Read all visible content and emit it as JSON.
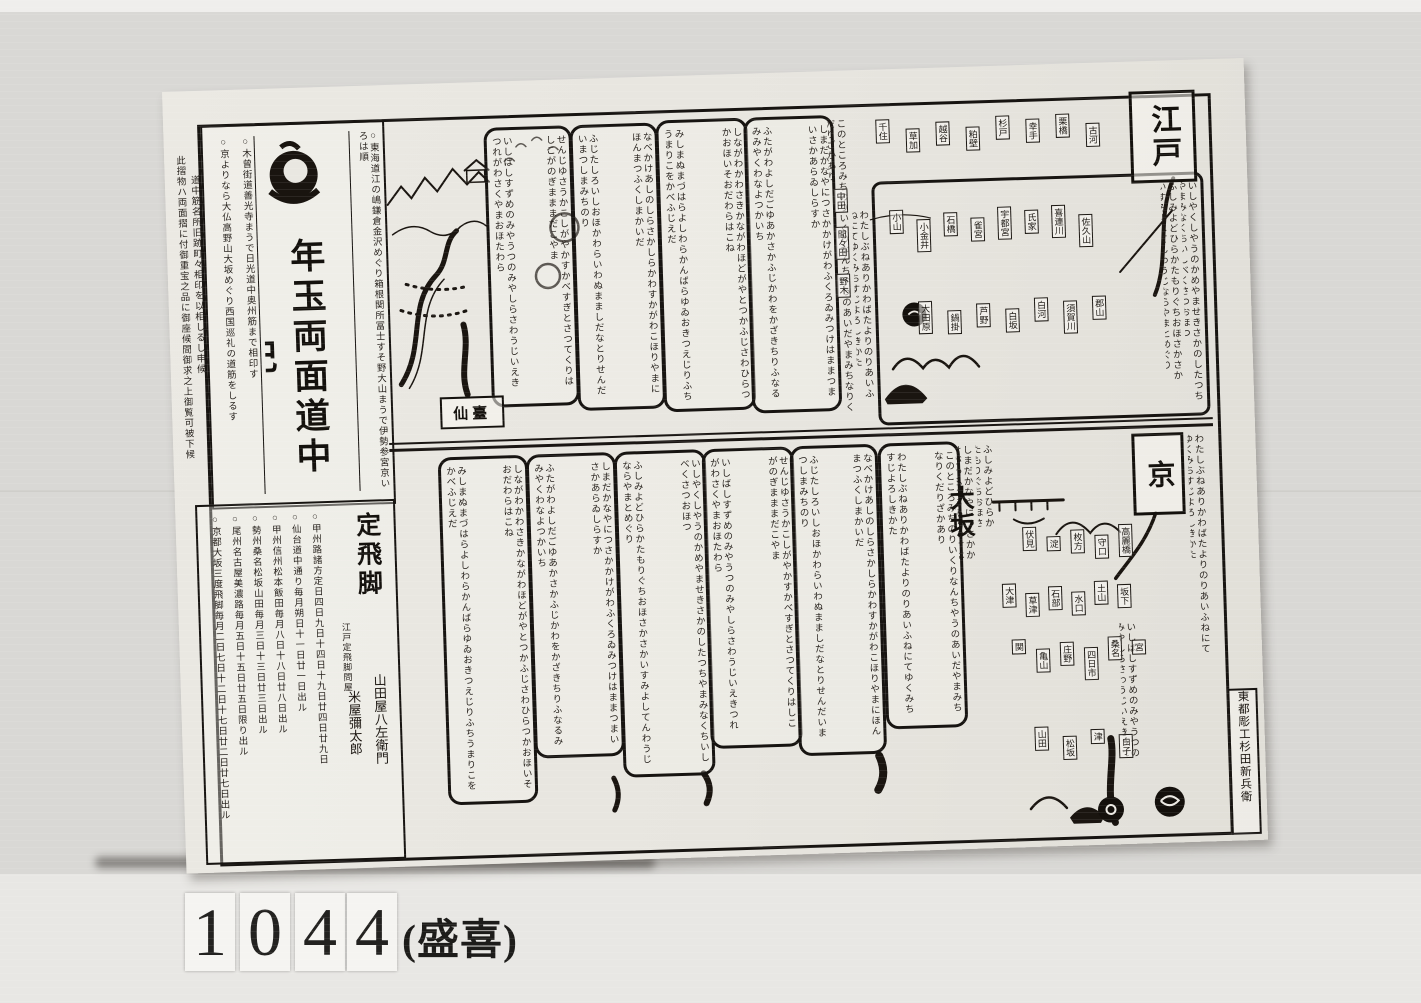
{
  "catalog": {
    "digits": [
      "1",
      "0",
      "4",
      "4"
    ],
    "annotation": "(盛喜)"
  },
  "sheet": {
    "title": "年玉両面道中記",
    "edo_label": "江戸",
    "kyoto_label": "京",
    "osaka_label": "大坂",
    "sendai_label": "仙臺",
    "colophon": "東都彫工杉田新兵衛",
    "courier": {
      "header": "定飛脚",
      "subheader": "江戸定飛脚問屋",
      "name_1": "米屋彌太郎",
      "name_2": "山田屋八左衛門"
    }
  },
  "texture": {
    "margin_note_1": "此摺物ハ両面摺に付御重宝之品に御座候間御求之上御覧可被下候",
    "margin_note_2": "道中筋名所旧跡町々相印を以相しるし申候",
    "title_side_right": "○東海道江の嶋鎌倉金沢めぐり箱根関所冨士すそ野大山まうで伊勢参宮京いろは順",
    "title_side_left_1": "○京よりなら大仏高野山大坂めぐり西国巡礼の道筋をしるす",
    "title_side_left_2": "○木曾街道善光寺まうで日光道中奥州筋まで相印す",
    "schedule_1": "○京都大坂三度飛脚毎月二日七日十二日十七日廿二日廿七日出ル",
    "schedule_2": "○尾州名古屋美濃路毎月五日十五日廿五日限り出ル",
    "schedule_3": "○勢州桑名松坂山田毎月三日十三日廿三日出ル",
    "schedule_4": "○甲州信州松本飯田毎月八日十八日廿八日出ル",
    "schedule_5": "○仙台道中通り毎月朔日十一日廿一日出ル",
    "schedule_6": "○甲州路諸方定日四日九日十四日十九日廿四日廿九日",
    "cols": [
      "しながわかわさきかながわほどがやとつかふじさわひらつかおほいそおだわらはこね",
      "みしまぬまづはらよしわらかんばらゆゐおきつえじりふちうまりこをかべふじえだ",
      "しまだかなやにつさかかけがわふくろゐみつけはままつまいさかあらゐしらすか",
      "ふたがわよしだごゆあかさかふじかわをかざきちりふなるみみやくわなよつかいち",
      "いしやくしやうのかめやませきさかのしたつちやまみなくちいしべくさつおほつ",
      "ふしみよどひらかたもりぐちおほさかさかいすみよしてんわうじならやまとめぐり",
      "せんじゆさうかこしがやかすかべすぎとさつてくりはしこがのぎまままだこやま",
      "いしばしすずめのみやうつのみやしらさわうじいえきつれがわさくやまおほたわら",
      "なべかけあしのしらさかしらかわすかがわこほりやまにほんまつふくしまかいだ",
      "ふじたしろいしおほかわらいわぬまましだなとりせんだいまつしまみちのり",
      "このところみちのりいくりなんちやうのあいだやまみちなりくだりざかあり",
      "わたしぶねありかわばたよりのりあいふねにてゆくみちすじよろしきかた"
    ],
    "boxes_top": [
      "千住",
      "草加",
      "越谷",
      "粕壁",
      "杉戸",
      "幸手",
      "栗橋",
      "古河"
    ],
    "boxes_mid1": [
      "小山",
      "小金井",
      "石橋",
      "雀宮",
      "宇都宮",
      "氏家",
      "喜連川",
      "佐久山"
    ],
    "boxes_mid2": [
      "大田原",
      "鍋掛",
      "芦野",
      "白坂",
      "白河",
      "須賀川",
      "郡山"
    ],
    "boxes_scatter": [
      "中田",
      "間々田",
      "野木"
    ],
    "boxes_b1": [
      "伏見",
      "淀",
      "枚方",
      "守口",
      "高麗橋"
    ],
    "boxes_b2": [
      "大津",
      "草津",
      "石部",
      "水口",
      "土山",
      "坂下"
    ],
    "boxes_b3": [
      "関",
      "亀山",
      "庄野",
      "四日市",
      "桑名",
      "宮"
    ],
    "boxes_b4": [
      "山田",
      "松坂",
      "津",
      "白子"
    ]
  }
}
